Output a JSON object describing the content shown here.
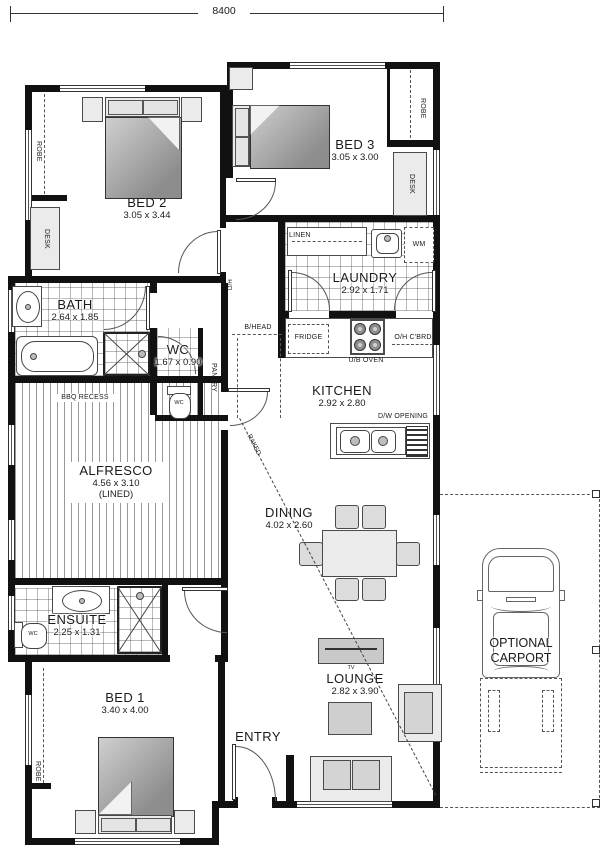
{
  "dimension": {
    "width_label": "8400"
  },
  "rooms": {
    "bed2": {
      "name": "BED 2",
      "dims": "3.05 x 3.44"
    },
    "bed3": {
      "name": "BED 3",
      "dims": "3.05 x 3.00"
    },
    "laundry": {
      "name": "LAUNDRY",
      "dims": "2.92 x 1.71"
    },
    "kitchen": {
      "name": "KITCHEN",
      "dims": "2.92 x 2.80"
    },
    "bath": {
      "name": "BATH",
      "dims": "2.64 x 1.85"
    },
    "wc": {
      "name": "WC",
      "dims": "1.67 x 0.90"
    },
    "alfresco": {
      "name": "ALFRESCO",
      "dims": "4.56 x 3.10",
      "note": "(LINED)"
    },
    "dining": {
      "name": "DINING",
      "dims": "4.02 x 2.60"
    },
    "lounge": {
      "name": "LOUNGE",
      "dims": "2.82 x 3.90"
    },
    "ensuite": {
      "name": "ENSUITE",
      "dims": "2.25 x 1.31"
    },
    "bed1": {
      "name": "BED 1",
      "dims": "3.40 x 4.00"
    },
    "entry": {
      "name": "ENTRY"
    },
    "carport": {
      "line1": "OPTIONAL",
      "line2": "CARPORT"
    }
  },
  "fixtures": {
    "robe": "ROBE",
    "desk": "DESK",
    "linen": "LINEN",
    "washing_machine": "WM",
    "fridge": "FRIDGE",
    "under_bench_oven": "U/B OVEN",
    "overhead_cupboard": "O/H C'BRD",
    "dishwasher_opening": "D/W OPENING",
    "pantry": "PANTRY",
    "bulkhead": "B/HEAD",
    "door_head": "D/H",
    "bbq_recess": "BBQ RECESS",
    "tv": "TV",
    "wc_pan": "WC",
    "raked": "RAKED"
  },
  "colors": {
    "wall": "#111111",
    "line": "#555555",
    "furniture_fill": "#d9d9d9",
    "bed_fill": "#9c9c9c",
    "floor": "#ffffff"
  }
}
